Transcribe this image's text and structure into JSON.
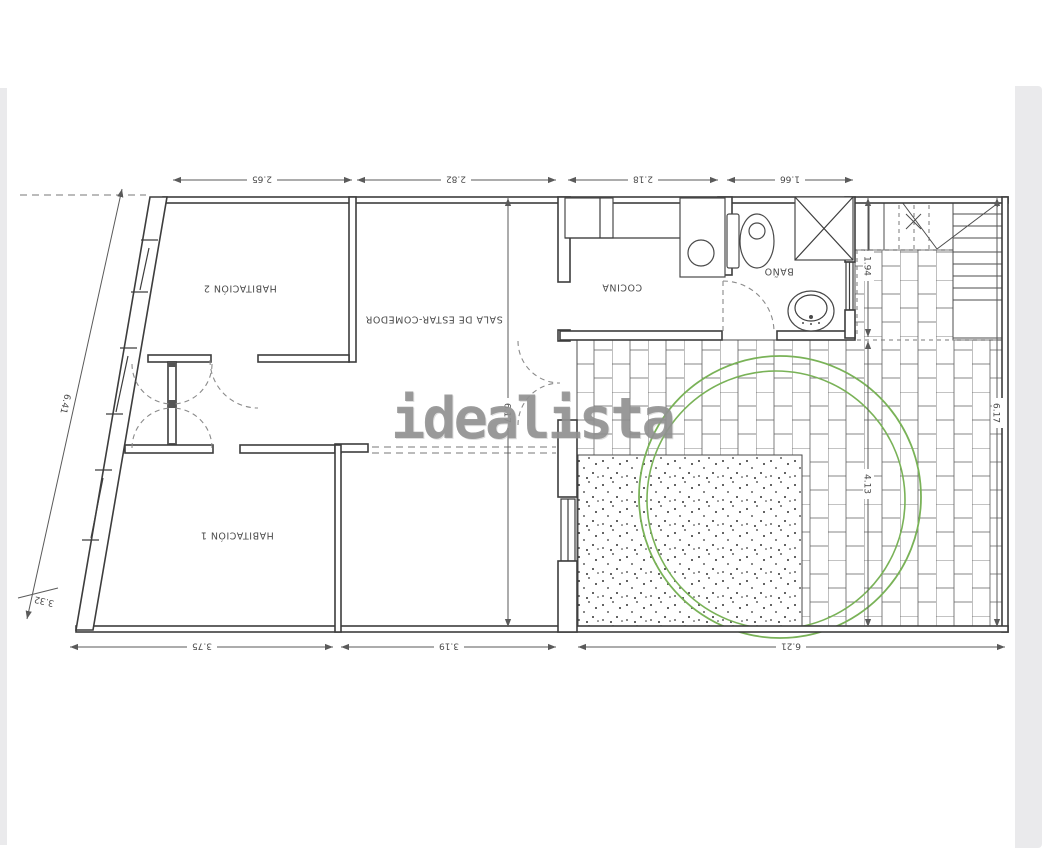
{
  "watermark": {
    "text": "idealista"
  },
  "colors": {
    "wall_line": "#3d3d3d",
    "dim_line": "#5a5a5a",
    "brick_line": "#5f5f5f",
    "green_circle": "#79b257",
    "dot_color": "#333333",
    "photo_edge": "#eaeaec"
  },
  "rooms": [
    {
      "id": "habitacion-2",
      "label": "HABITACIÓN 2"
    },
    {
      "id": "sala",
      "label": "SALA DE ESTAR-COMEDOR"
    },
    {
      "id": "cocina",
      "label": "COCINA"
    },
    {
      "id": "bano",
      "label": "BAÑO"
    },
    {
      "id": "habitacion-1",
      "label": "HABITACIÓN 1"
    }
  ],
  "dimensions": {
    "top": [
      "2.65",
      "2.82",
      "2.18",
      "1.66"
    ],
    "bottom": [
      "3.75",
      "3.19",
      "6.21"
    ],
    "left_diagonal": "6.41",
    "left_bottom": "3.32",
    "middle_vertical": "6.17",
    "stairs_vertical": "1.94",
    "terrace_vertical": "4.13",
    "right_vertical": "6.17"
  }
}
